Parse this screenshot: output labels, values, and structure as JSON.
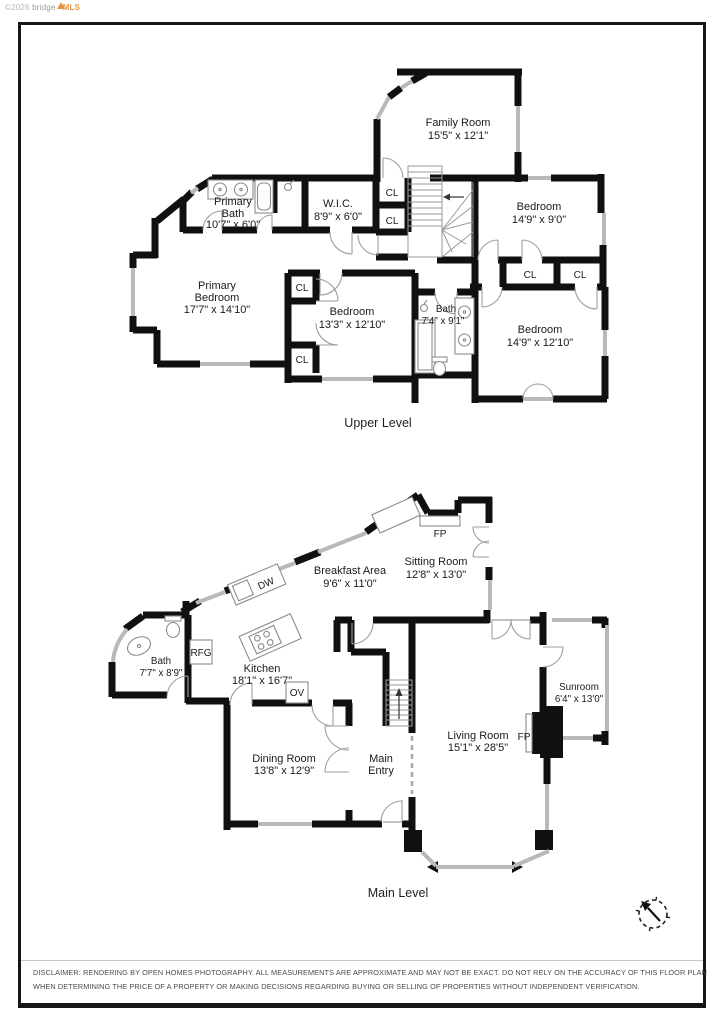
{
  "watermark": {
    "copyright": "©2026",
    "brand": "bridge",
    "brand_bold": "MLS"
  },
  "upper_level": {
    "caption": "Upper Level",
    "closet_label": "CL",
    "rooms": {
      "family_room": {
        "name": "Family Room",
        "lines": [
          "Family Room",
          "15'5\" x 12'1\""
        ]
      },
      "primary_bath": {
        "name": "Primary Bath",
        "lines": [
          "Primary",
          "Bath",
          "10'7\" x 6'0\""
        ]
      },
      "wic": {
        "name": "W.I.C.",
        "lines": [
          "W.I.C.",
          "8'9\" x 6'0\""
        ]
      },
      "bedroom_ne": {
        "name": "Bedroom",
        "lines": [
          "Bedroom",
          "14'9\" x 9'0\""
        ]
      },
      "primary_bedroom": {
        "name": "Primary Bedroom",
        "lines": [
          "Primary",
          "Bedroom",
          "17'7\" x 14'10\""
        ]
      },
      "bedroom_mid": {
        "name": "Bedroom",
        "lines": [
          "Bedroom",
          "13'3\" x 12'10\""
        ]
      },
      "bath": {
        "name": "Bath",
        "lines": [
          "Bath",
          "7'4\" x 9'1\""
        ]
      },
      "bedroom_se": {
        "name": "Bedroom",
        "lines": [
          "Bedroom",
          "14'9\" x 12'10\""
        ]
      }
    }
  },
  "main_level": {
    "caption": "Main Level",
    "appliances": {
      "fireplace": "FP",
      "dishwasher": "DW",
      "refrigerator": "RFG",
      "oven": "OV"
    },
    "rooms": {
      "breakfast_area": {
        "name": "Breakfast Area",
        "lines": [
          "Breakfast Area",
          "9'6\" x 11'0\""
        ]
      },
      "sitting_room": {
        "name": "Sitting Room",
        "lines": [
          "Sitting Room",
          "12'8\" x 13'0\""
        ]
      },
      "bath": {
        "name": "Bath",
        "lines": [
          "Bath",
          "7'7\" x 8'9\""
        ]
      },
      "kitchen": {
        "name": "Kitchen",
        "lines": [
          "Kitchen",
          "18'1\" x 16'7\""
        ]
      },
      "sunroom": {
        "name": "Sunroom",
        "lines": [
          "Sunroom",
          "6'4\" x 13'0\""
        ]
      },
      "dining_room": {
        "name": "Dining Room",
        "lines": [
          "Dining Room",
          "13'8\" x 12'9\""
        ]
      },
      "main_entry": {
        "name": "Main Entry",
        "lines": [
          "Main",
          "Entry"
        ]
      },
      "living_room": {
        "name": "Living Room",
        "lines": [
          "Living Room",
          "15'1\" x 28'5\""
        ]
      }
    }
  },
  "disclaimer": {
    "line1": "DISCLAIMER: RENDERING BY OPEN HOMES PHOTOGRAPHY. ALL MEASUREMENTS ARE APPROXIMATE AND MAY NOT BE EXACT. DO NOT RELY ON THE ACCURACY OF THIS FLOOR PLAN",
    "line2": "WHEN DETERMINING THE PRICE OF A PROPERTY OR MAKING DECISIONS REGARDING BUYING OR SELLING OF PROPERTIES WITHOUT INDEPENDENT VERIFICATION."
  },
  "colors": {
    "wall": "#101010",
    "window_gray": "#b9b9b9",
    "accent_orange": "#e8963c"
  }
}
